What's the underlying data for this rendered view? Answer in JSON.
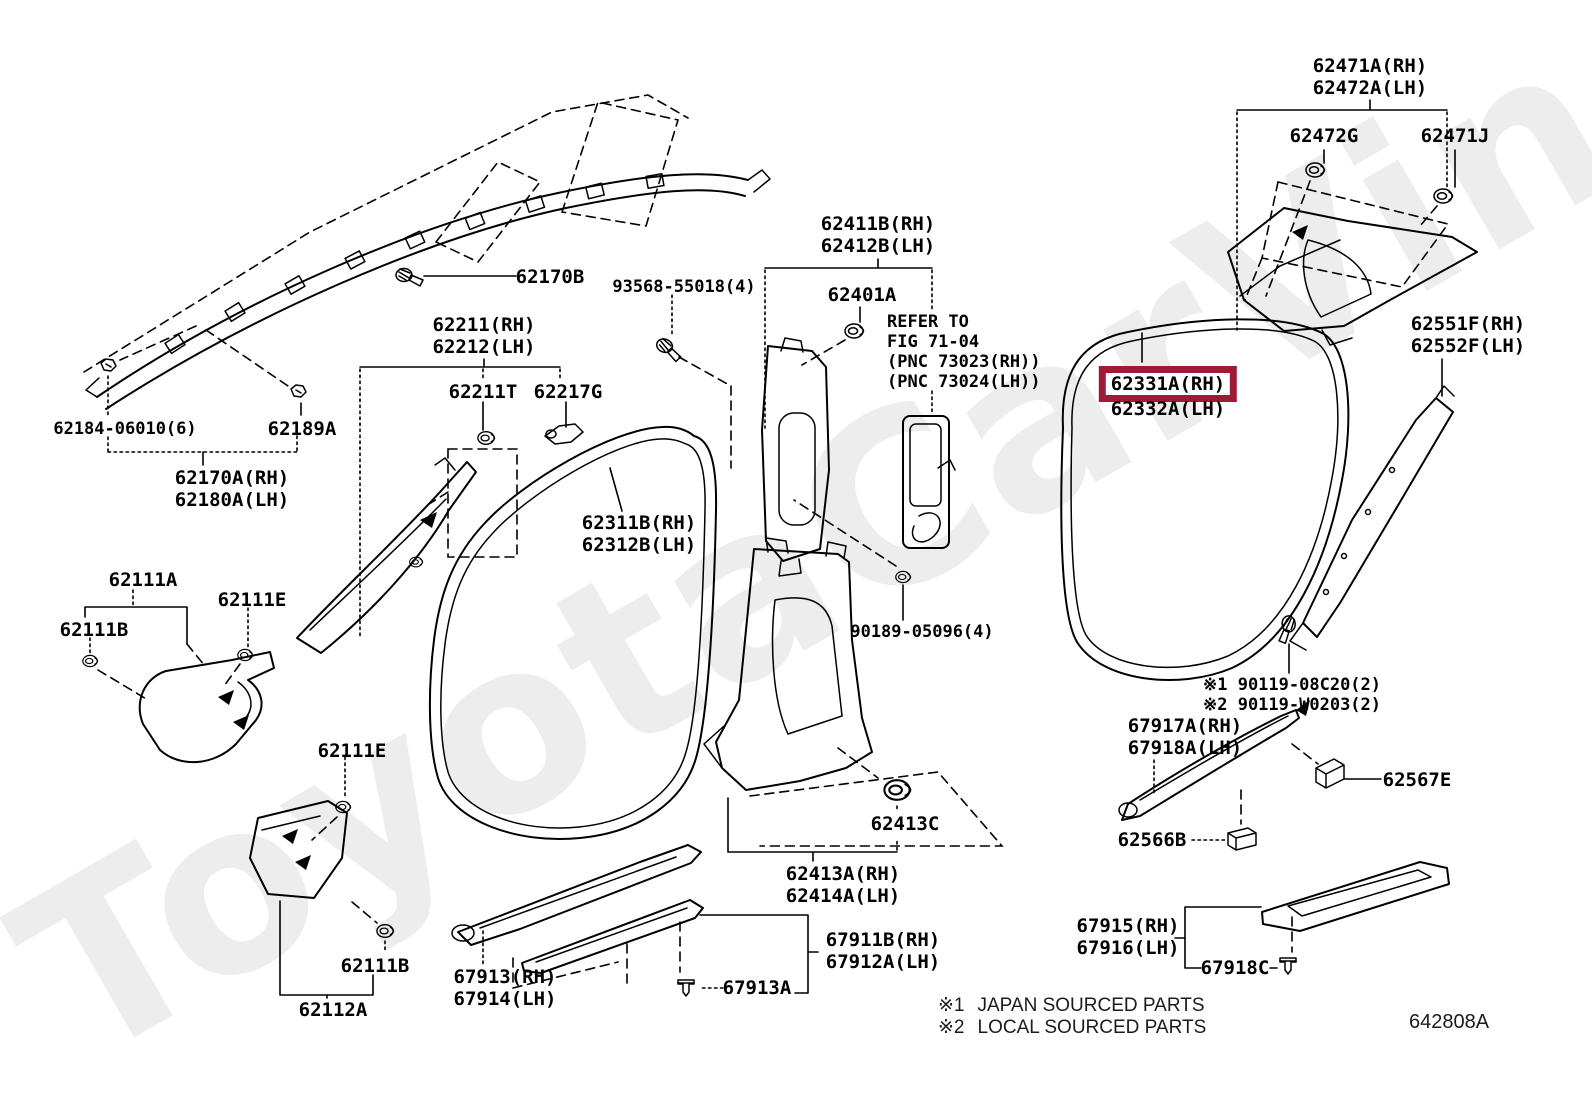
{
  "watermark": "ToyotaCarVine.ru",
  "diagram_code": "642808A",
  "highlight_color": "#9E1B37",
  "footer_notes": [
    {
      "marker": "※1",
      "text": "JAPAN SOURCED PARTS"
    },
    {
      "marker": "※2",
      "text": "LOCAL SOURCED PARTS"
    }
  ],
  "labels": [
    {
      "id": "62471A",
      "lines": [
        "62471A(RH)",
        "62472A(LH)"
      ],
      "x": 1370,
      "y": 55
    },
    {
      "id": "62472G",
      "lines": [
        "62472G"
      ],
      "x": 1324,
      "y": 125
    },
    {
      "id": "62471J",
      "lines": [
        "62471J"
      ],
      "x": 1455,
      "y": 125
    },
    {
      "id": "62551F",
      "lines": [
        "62551F(RH)",
        "62552F(LH)"
      ],
      "x": 1468,
      "y": 313
    },
    {
      "id": "62411B",
      "lines": [
        "62411B(RH)",
        "62412B(LH)"
      ],
      "x": 878,
      "y": 213
    },
    {
      "id": "62401A",
      "lines": [
        "62401A"
      ],
      "x": 862,
      "y": 284
    },
    {
      "id": "93568-55018",
      "lines": [
        "93568-55018(4)"
      ],
      "x": 684,
      "y": 277,
      "cls": "mono-sm"
    },
    {
      "id": "refer-fig-71-04",
      "lines": [
        "REFER TO",
        "FIG 71-04",
        "(PNC 73023(RH))",
        "(PNC 73024(LH))"
      ],
      "x": 887,
      "y": 312,
      "cls": "mono-sm",
      "align": "left"
    },
    {
      "id": "62170B",
      "lines": [
        "62170B"
      ],
      "x": 550,
      "y": 266
    },
    {
      "id": "62211",
      "lines": [
        "62211(RH)",
        "62212(LH)"
      ],
      "x": 484,
      "y": 314
    },
    {
      "id": "62211T",
      "lines": [
        "62211T"
      ],
      "x": 483,
      "y": 381
    },
    {
      "id": "62217G",
      "lines": [
        "62217G"
      ],
      "x": 568,
      "y": 381
    },
    {
      "id": "62184-06010",
      "lines": [
        "62184-06010(6)"
      ],
      "x": 125,
      "y": 419,
      "cls": "mono-sm"
    },
    {
      "id": "62189A",
      "lines": [
        "62189A"
      ],
      "x": 302,
      "y": 418
    },
    {
      "id": "62170A",
      "lines": [
        "62170A(RH)",
        "62180A(LH)"
      ],
      "x": 232,
      "y": 467
    },
    {
      "id": "62111A",
      "lines": [
        "62111A"
      ],
      "x": 143,
      "y": 569
    },
    {
      "id": "62111E-1",
      "lines": [
        "62111E"
      ],
      "x": 252,
      "y": 589
    },
    {
      "id": "62111B-1",
      "lines": [
        "62111B"
      ],
      "x": 94,
      "y": 619
    },
    {
      "id": "62311B",
      "lines": [
        "62311B(RH)",
        "62312B(LH)"
      ],
      "x": 639,
      "y": 512
    },
    {
      "id": "62331A",
      "lines": [
        "62331A(RH)"
      ],
      "x": 1168,
      "y": 366,
      "highlight": true
    },
    {
      "id": "62332A",
      "lines": [
        "62332A(LH)"
      ],
      "x": 1168,
      "y": 398
    },
    {
      "id": "90189-05096",
      "lines": [
        "90189-05096(4)"
      ],
      "x": 922,
      "y": 622,
      "cls": "mono-sm"
    },
    {
      "id": "90119-notes",
      "lines": [
        "※1 90119-08C20(2)",
        "※2 90119-W0203(2)"
      ],
      "x": 1203,
      "y": 675,
      "cls": "mono-sm",
      "align": "left"
    },
    {
      "id": "67917A",
      "lines": [
        "67917A(RH)",
        "67918A(LH)"
      ],
      "x": 1185,
      "y": 715
    },
    {
      "id": "62567E",
      "lines": [
        "62567E"
      ],
      "x": 1417,
      "y": 769
    },
    {
      "id": "62566B",
      "lines": [
        "62566B"
      ],
      "x": 1152,
      "y": 829
    },
    {
      "id": "62413C",
      "lines": [
        "62413C"
      ],
      "x": 905,
      "y": 813
    },
    {
      "id": "62413A",
      "lines": [
        "62413A(RH)",
        "62414A(LH)"
      ],
      "x": 843,
      "y": 863
    },
    {
      "id": "67911B",
      "lines": [
        "67911B(RH)",
        "67912A(LH)"
      ],
      "x": 883,
      "y": 929
    },
    {
      "id": "67913",
      "lines": [
        "67913(RH)",
        "67914(LH)"
      ],
      "x": 505,
      "y": 966
    },
    {
      "id": "67913A",
      "lines": [
        "67913A"
      ],
      "x": 757,
      "y": 977
    },
    {
      "id": "62111E-2",
      "lines": [
        "62111E"
      ],
      "x": 352,
      "y": 740
    },
    {
      "id": "62111B-2",
      "lines": [
        "62111B"
      ],
      "x": 375,
      "y": 955
    },
    {
      "id": "62112A",
      "lines": [
        "62112A"
      ],
      "x": 333,
      "y": 999
    },
    {
      "id": "67915",
      "lines": [
        "67915(RH)",
        "67916(LH)"
      ],
      "x": 1128,
      "y": 915
    },
    {
      "id": "67918C",
      "lines": [
        "67918C"
      ],
      "x": 1235,
      "y": 957
    }
  ]
}
